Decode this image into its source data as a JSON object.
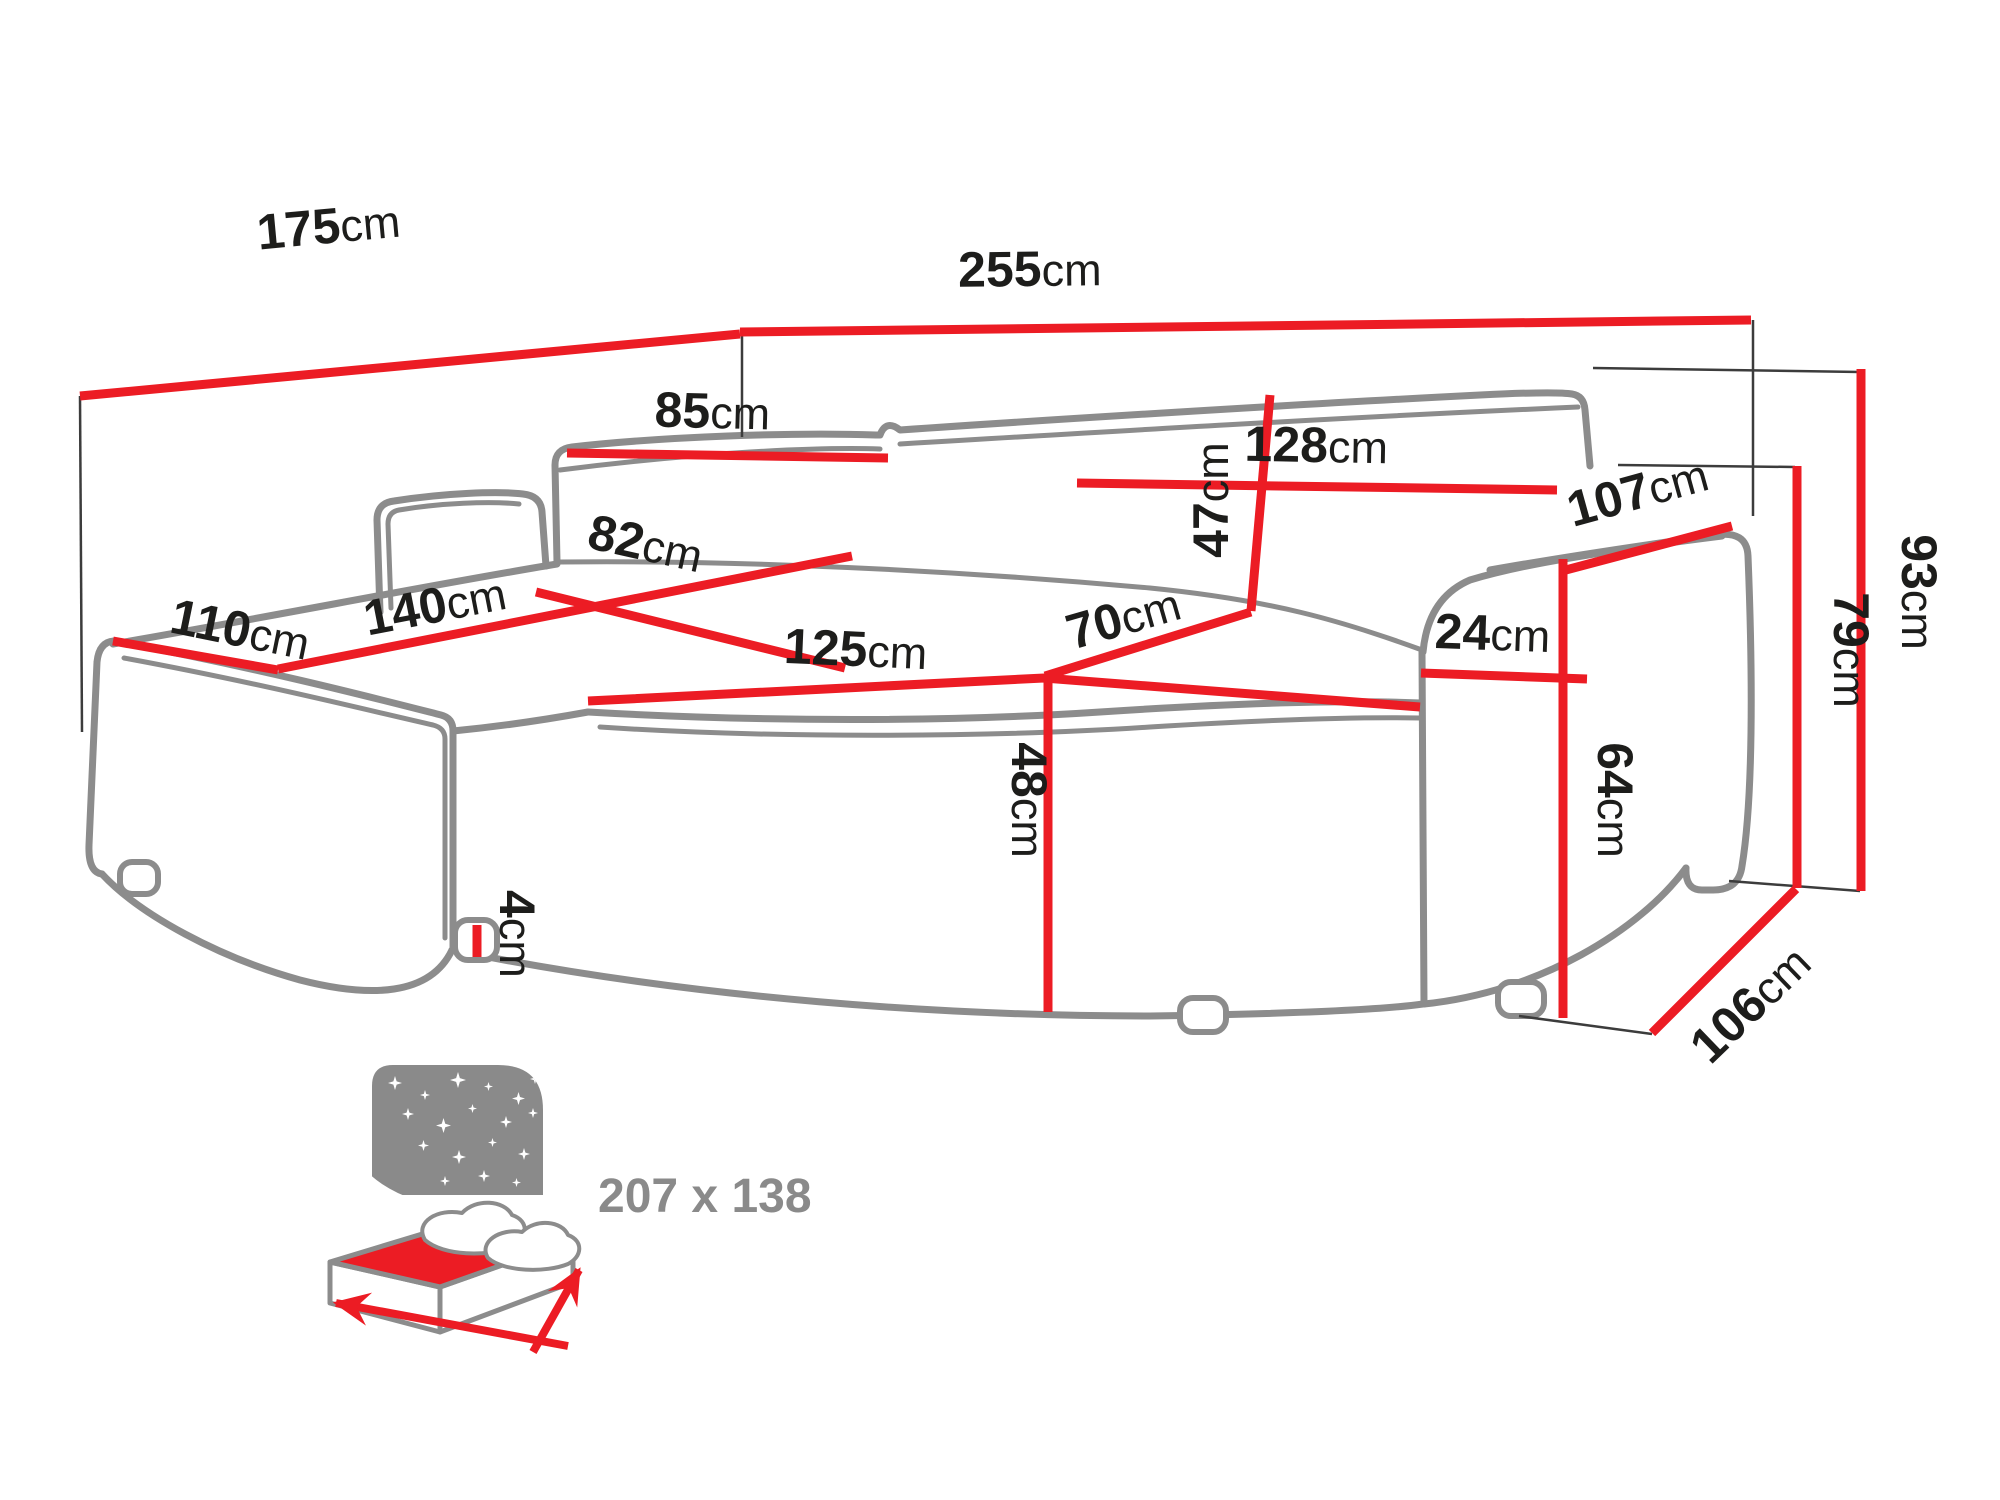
{
  "colors": {
    "dimension_line": "#ec1c24",
    "sofa_outline": "#8c8c8c",
    "label_text": "#1d1d1b",
    "muted_text": "#8a8a8a"
  },
  "dims": {
    "chaise_side_width": {
      "value": "175",
      "unit": "cm"
    },
    "total_width": {
      "value": "255",
      "unit": "cm"
    },
    "back_cushion_left": {
      "value": "85",
      "unit": "cm"
    },
    "back_cushion_right": {
      "value": "128",
      "unit": "cm"
    },
    "backrest_height": {
      "value": "47",
      "unit": "cm"
    },
    "armrest_length": {
      "value": "107",
      "unit": "cm"
    },
    "armrest_width": {
      "value": "24",
      "unit": "cm"
    },
    "total_height": {
      "value": "93",
      "unit": "cm"
    },
    "armrest_height": {
      "value": "79",
      "unit": "cm"
    },
    "base_side_height": {
      "value": "64",
      "unit": "cm"
    },
    "side_depth": {
      "value": "106",
      "unit": "cm"
    },
    "seat_height": {
      "value": "48",
      "unit": "cm"
    },
    "seat_width": {
      "value": "125",
      "unit": "cm"
    },
    "seat_depth": {
      "value": "70",
      "unit": "cm"
    },
    "chaise_front_width": {
      "value": "110",
      "unit": "cm"
    },
    "chaise_length": {
      "value": "140",
      "unit": "cm"
    },
    "chaise_seat_width": {
      "value": "82",
      "unit": "cm"
    },
    "leg_height": {
      "value": "4",
      "unit": "cm"
    }
  },
  "sleeping_area": {
    "size_label": "207 x 138"
  }
}
